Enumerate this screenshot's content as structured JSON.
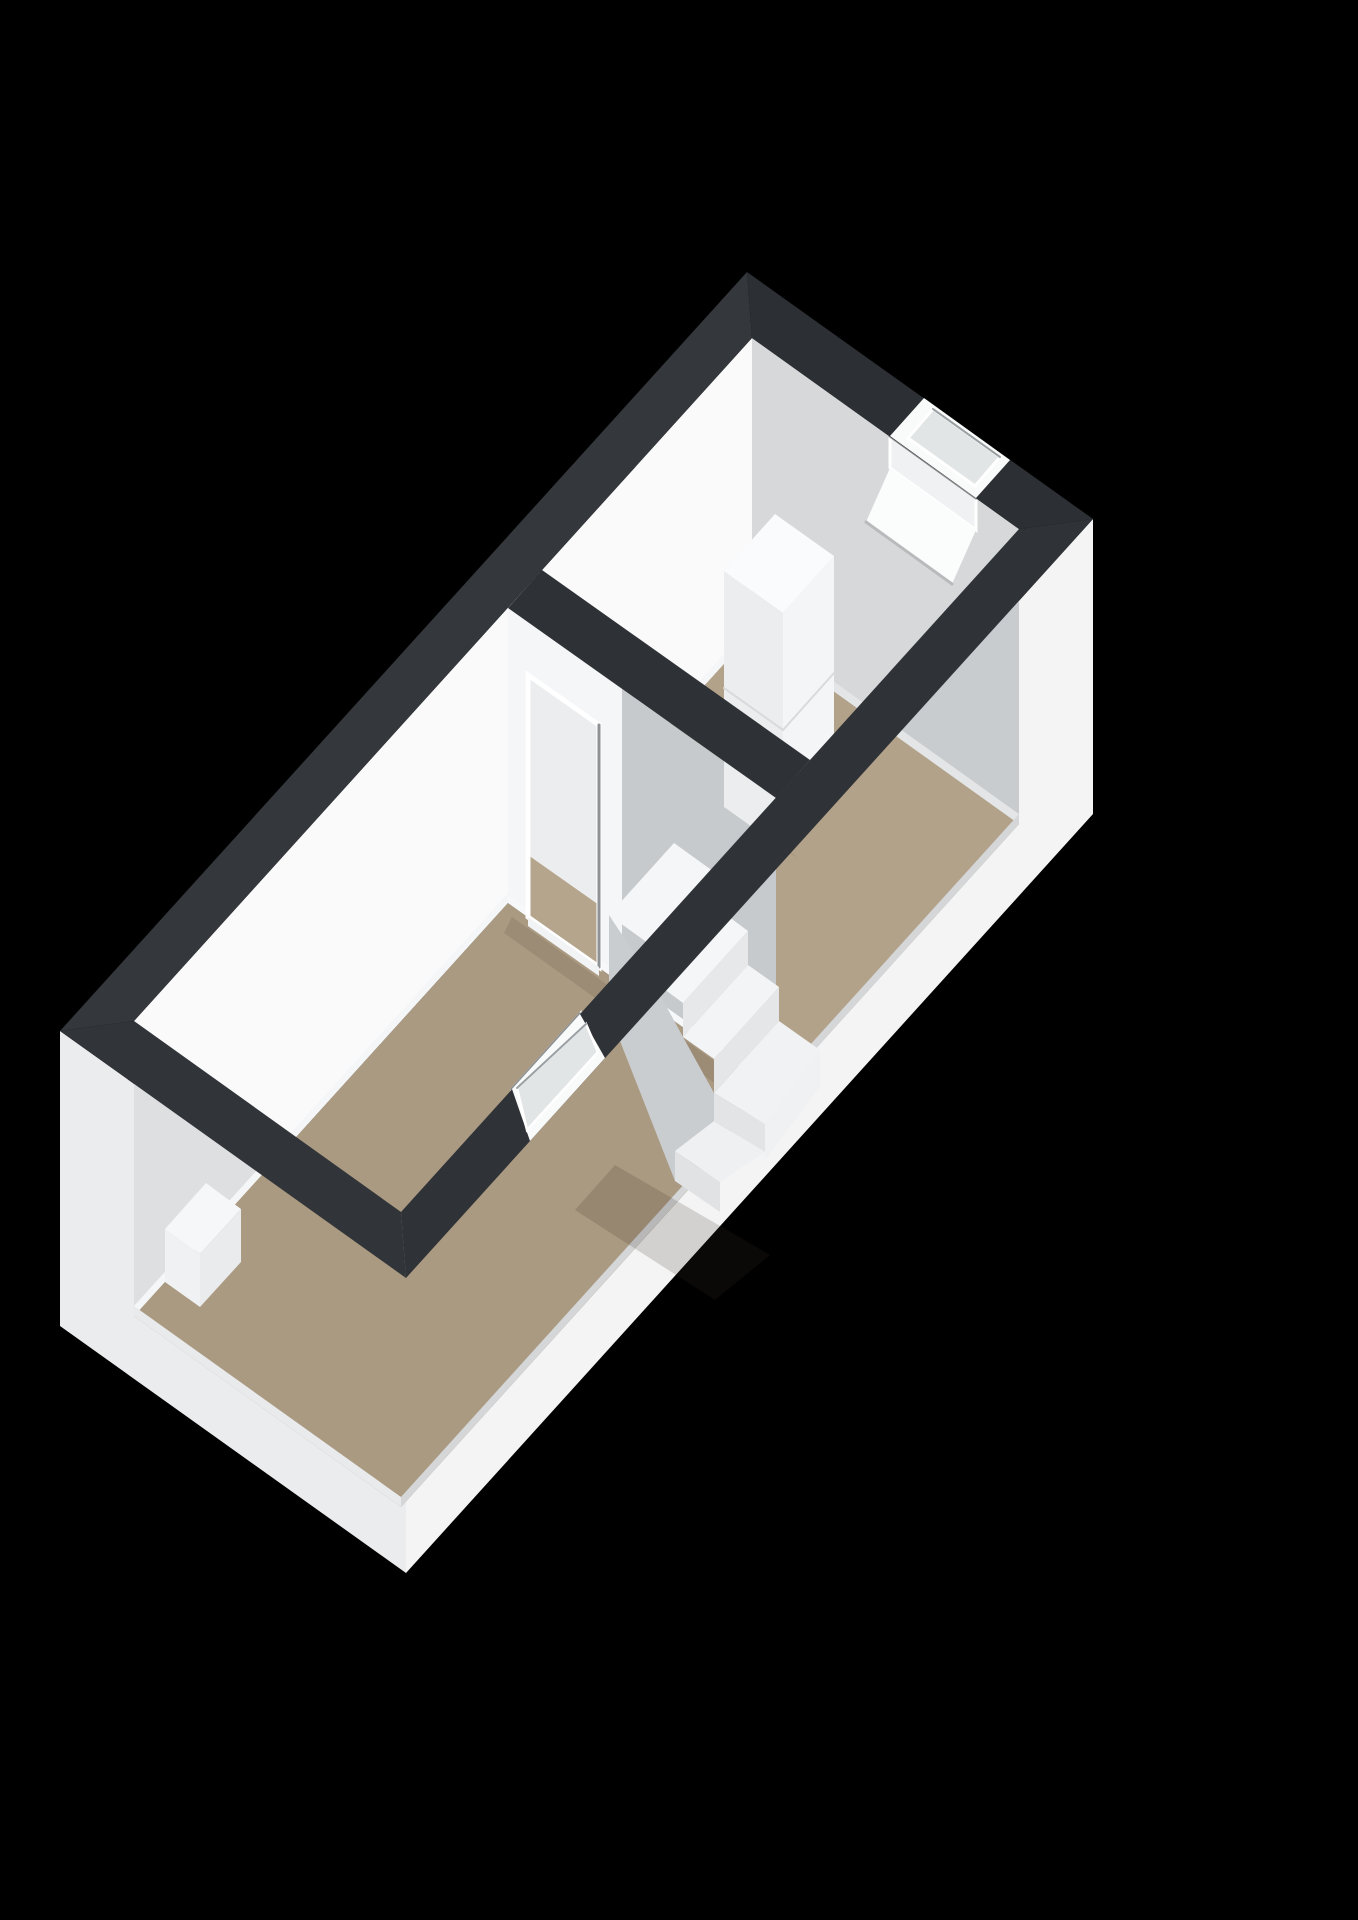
{
  "scene": {
    "label": "3D isometric floor plan render",
    "view": "axonometric top-down",
    "background": "#000000",
    "rooms": [
      {
        "name": "upper-room",
        "floor": "tan",
        "features": [
          "cabinet-unit",
          "recessed-high-window"
        ]
      },
      {
        "name": "lower-room",
        "floor": "tan",
        "features": [
          "doorway",
          "winder-staircase",
          "recessed-front-window",
          "low-white-box"
        ]
      }
    ],
    "colors": {
      "background": "#000000",
      "wall_top_band_tl": "#34373b",
      "wall_top_band_tr": "#2c2f33",
      "wall_top_band_front": "#2f3236",
      "wall_top_band_left": "#313438",
      "wall_top_band_divider": "#2e3135",
      "exterior_right": "#f4f4f5",
      "exterior_left": "#ebeced",
      "interior_back_left": "#fafafb",
      "interior_top_right": "#d6d8da",
      "interior_front_right": "#c9ccce",
      "interior_front_left": "#dddfe1",
      "divider_light": "#f5f6f7",
      "divider_shaded": "#c7cacc",
      "floor_upper": "#b3a28a",
      "floor_lower": "#ab9a82",
      "stair_tread": "#f5f6f8",
      "stair_riser": "#e6e8ea",
      "stair_under": "#cacdd0",
      "cabinet_top": "#fafbfc",
      "cabinet_front": "#ebedee",
      "cabinet_side": "#f4f5f6",
      "window_frame": "#ffffff",
      "window_glass": "#e2e5e6",
      "window_recess": "#8b8e91",
      "door_through_wall": "#ecedee",
      "door_through_floor": "#b6a58d"
    }
  }
}
